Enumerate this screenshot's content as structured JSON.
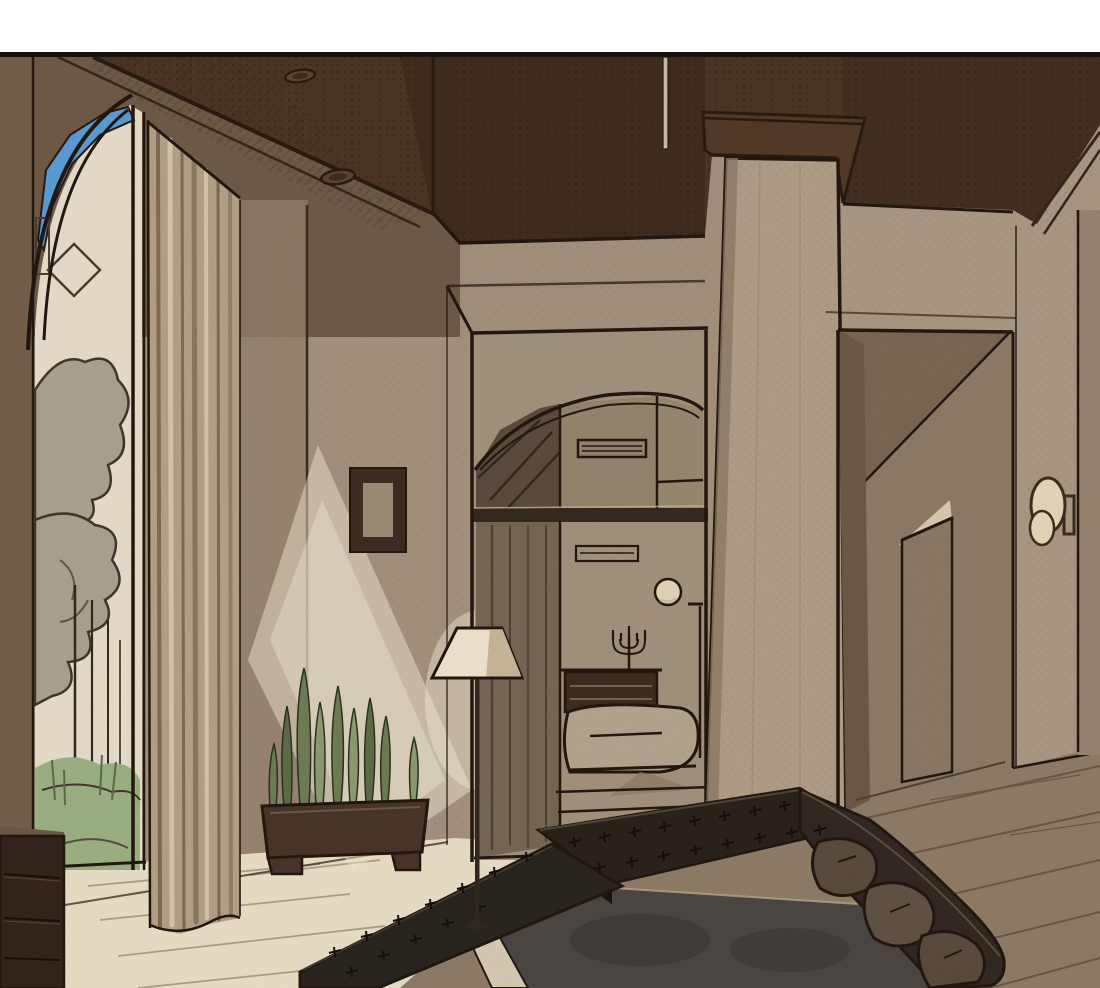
{
  "image": {
    "kind": "comic-panel-interior-illustration",
    "width": 1100,
    "height": 988,
    "text_content": "none"
  },
  "panel": {
    "top_margin_color": "#ffffff",
    "border_line_color": "#1a110a"
  },
  "scene": {
    "style": "manhwa screen-tone interior",
    "objects": [
      "coffered-dark-ceiling",
      "recessed-ceiling-lights",
      "hanging-ceiling-box",
      "ceiling-rod",
      "tall-arched-window",
      "blue-sky-through-arch",
      "garden-trees-outside",
      "grass-outside",
      "floor-length-curtain",
      "wall-picture-frame",
      "light-beam-on-wall",
      "arched-transom-doorway",
      "louver-vents",
      "inner-bedroom",
      "bed-with-blanket",
      "dresser",
      "candelabra",
      "round-wall-clock",
      "thin-floor-lamp-inner",
      "square-pillar",
      "hallway-opening",
      "interior-door",
      "wall-sconce",
      "floor-lamp-with-shade",
      "planter-box",
      "spiky-sansevieria-plants",
      "black-tufted-sectional-sofa",
      "brown-seat-cushions",
      "sunken-dark-table",
      "cream-ledge",
      "side-cabinet-drawers",
      "cream-tile-floor",
      "wood-plank-floor"
    ]
  },
  "palette": {
    "paper": "#ffffff",
    "ink": "#1f150d",
    "ceiling": "#4a3323",
    "ceiling_deep": "#38261a",
    "fascia": "#563b29",
    "shadow_wall": "#6e5947",
    "wall": "#a4927e",
    "wall_right": "#ab9984",
    "wall_far_right": "#97836e",
    "wall_shadow": "#93806c",
    "column": "#b29e88",
    "doorway_inner": "#a3927d",
    "transom_glass": "#93836c",
    "transom_dark": "#594a3d",
    "inner_curtain": "#756654",
    "sill_dark": "#32271d",
    "clock_face": "#e6d8ba",
    "bed": "#b4a690",
    "dark_wood": "#3a2a1e",
    "sky": "#5b9cd8",
    "outside": "#e9e0cd",
    "foliage": "#a9a493",
    "grass": "#9cb284",
    "trunk": "#2e2820",
    "curtain": "#b4a288",
    "curtain_dark": "#806a53",
    "curtain_light": "#d7c7ad",
    "beam": "#f3e9d4",
    "frame": "#3a2a1f",
    "frame_inner": "#9c8b76",
    "lamp_shade": "#f0e6d1",
    "lamp_shade_shadow": "#cbb89b",
    "lamp_pole": "#2f251c",
    "sconce": "#e7d9bb",
    "hall_inner": "#8d7b67",
    "hall_dark": "#6b5745",
    "hall_ceiling": "#7a6552",
    "hall_door": "#8a7863",
    "hall_light": "#dacbb1",
    "sofa": "#272019",
    "sofa_deep": "#161209",
    "sofa_edge": "#4d443a",
    "sofa_right": "#2e261f",
    "cushion": "#57493c",
    "cushion2": "#5f5143",
    "pit": "#4a4540",
    "pit_dark": "#34302c",
    "ledge": "#d9cdb4",
    "floor_cream": "#ece1c8",
    "floor_wood": "#8f7c66",
    "plank": "#5f4e3d",
    "cabinet": "#31231a",
    "cabinet_top": "#6d5645",
    "planter": "#473227",
    "leaf": "#6f7c55",
    "leaf_light": "#8e9b73",
    "leaf_dark": "#5d6b47",
    "light_pool": "#f7efdc"
  }
}
